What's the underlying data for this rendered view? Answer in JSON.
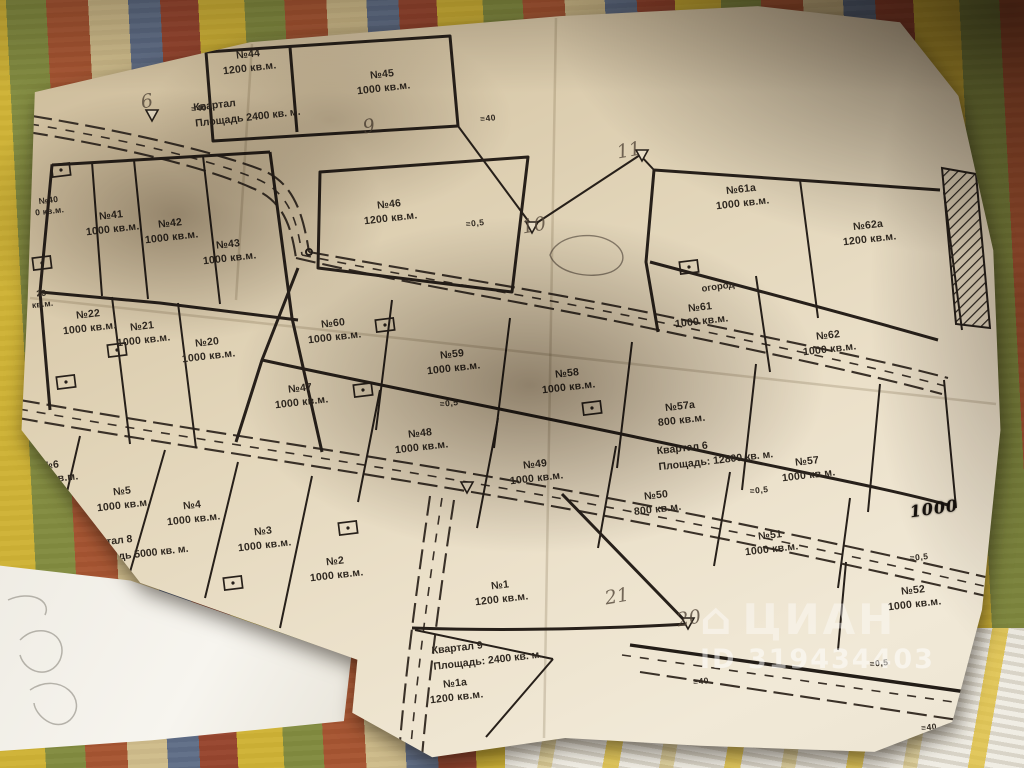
{
  "map": {
    "plots": [
      {
        "number": "№44",
        "area": "1200 кв.м."
      },
      {
        "number": "№45",
        "area": "1000 кв.м."
      },
      {
        "number": "№46",
        "area": "1200 кв.м."
      },
      {
        "number": "№40",
        "area": "0 кв.м."
      },
      {
        "number": "№41",
        "area": "1000 кв.м."
      },
      {
        "number": "№42",
        "area": "1000 кв.м."
      },
      {
        "number": "№43",
        "area": "1000 кв.м."
      },
      {
        "number": "23",
        "area": "кв.м."
      },
      {
        "number": "№22",
        "area": "1000 кв.м."
      },
      {
        "number": "№21",
        "area": "1000 кв.м."
      },
      {
        "number": "№20",
        "area": "1000 кв.м."
      },
      {
        "number": "№60",
        "area": "1000 кв.м."
      },
      {
        "number": "№59",
        "area": "1000 кв.м."
      },
      {
        "number": "№58",
        "area": "1000 кв.м."
      },
      {
        "number": "№47",
        "area": "1000 кв.м."
      },
      {
        "number": "№48",
        "area": "1000 кв.м."
      },
      {
        "number": "№49",
        "area": "1000 кв.м."
      },
      {
        "number": "№61а",
        "area": "1000 кв.м."
      },
      {
        "number": "№62а",
        "area": "1200 кв.м."
      },
      {
        "number": "№61",
        "area": "1000 кв.м."
      },
      {
        "number": "№62",
        "area": "1000 кв.м."
      },
      {
        "number": "№57а",
        "area": "800 кв.м."
      },
      {
        "number": "№57",
        "area": "1000 кв.м."
      },
      {
        "number": "№50",
        "area": "800 кв.м."
      },
      {
        "number": "№51",
        "area": "1000 кв.м."
      },
      {
        "number": "№52",
        "area": "1000 кв.м."
      },
      {
        "number": "№6",
        "area": "1000 кв.м."
      },
      {
        "number": "№5",
        "area": "1000 кв.м."
      },
      {
        "number": "№4",
        "area": "1000 кв.м."
      },
      {
        "number": "№3",
        "area": "1000 кв.м."
      },
      {
        "number": "№2",
        "area": "1000 кв.м."
      },
      {
        "number": "№1",
        "area": "1200 кв.м."
      },
      {
        "number": "№1а",
        "area": "1200 кв.м."
      }
    ],
    "quarters": [
      {
        "line1": "Квартал",
        "line2": "Площадь 2400 кв. м."
      },
      {
        "line1": "Квартал 6",
        "line2": "Площадь: 12800 кв. м."
      },
      {
        "line1": "Квартал 8",
        "line2": "Площадь 5000 кв. м."
      },
      {
        "line1": "Квартал 9",
        "line2": "Площадь: 2400 кв. м."
      }
    ],
    "notes": [
      {
        "text": "огород"
      },
      {
        "text": "1000"
      }
    ],
    "vertex_numbers": [
      "6",
      "9",
      "10",
      "11",
      "20",
      "21",
      "24"
    ],
    "benchmarks": [
      "≡40",
      "≡40",
      "≡0,5",
      "≡0,5",
      "≡0,5",
      "≡0,5",
      "≡40",
      "≡40",
      "≡0,5",
      "≡40"
    ]
  },
  "watermark": {
    "brand": "ЦИАН",
    "id": "ID 319434403"
  },
  "colors": {
    "paper": "#e7dcc4",
    "ink": "#27201a",
    "textile_yellow": "#d6b934",
    "textile_green": "#7e8c40",
    "textile_red": "#a84e30"
  }
}
